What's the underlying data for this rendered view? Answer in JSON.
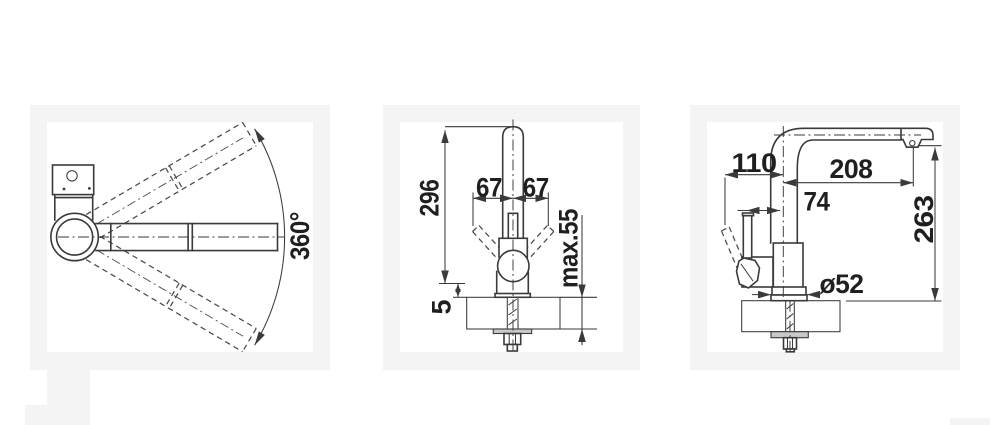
{
  "colors": {
    "page_bg": "#ffffff",
    "panel_mat": "#f4f4f4",
    "ink": "#3a3a3a",
    "label_ink": "#1f1f1f",
    "washer_fill": "#c9c9c9"
  },
  "views": {
    "top": {
      "swivel_angle": "360°"
    },
    "front": {
      "overall_height": "296",
      "lever_swing_left": "67",
      "lever_swing_right": "67",
      "max_counter_thickness": "max.55",
      "base_gap": "5"
    },
    "side": {
      "lever_reach": "110",
      "spout_reach": "208",
      "lever_offset": "74",
      "outlet_height": "263",
      "base_diameter": "ø52"
    }
  }
}
